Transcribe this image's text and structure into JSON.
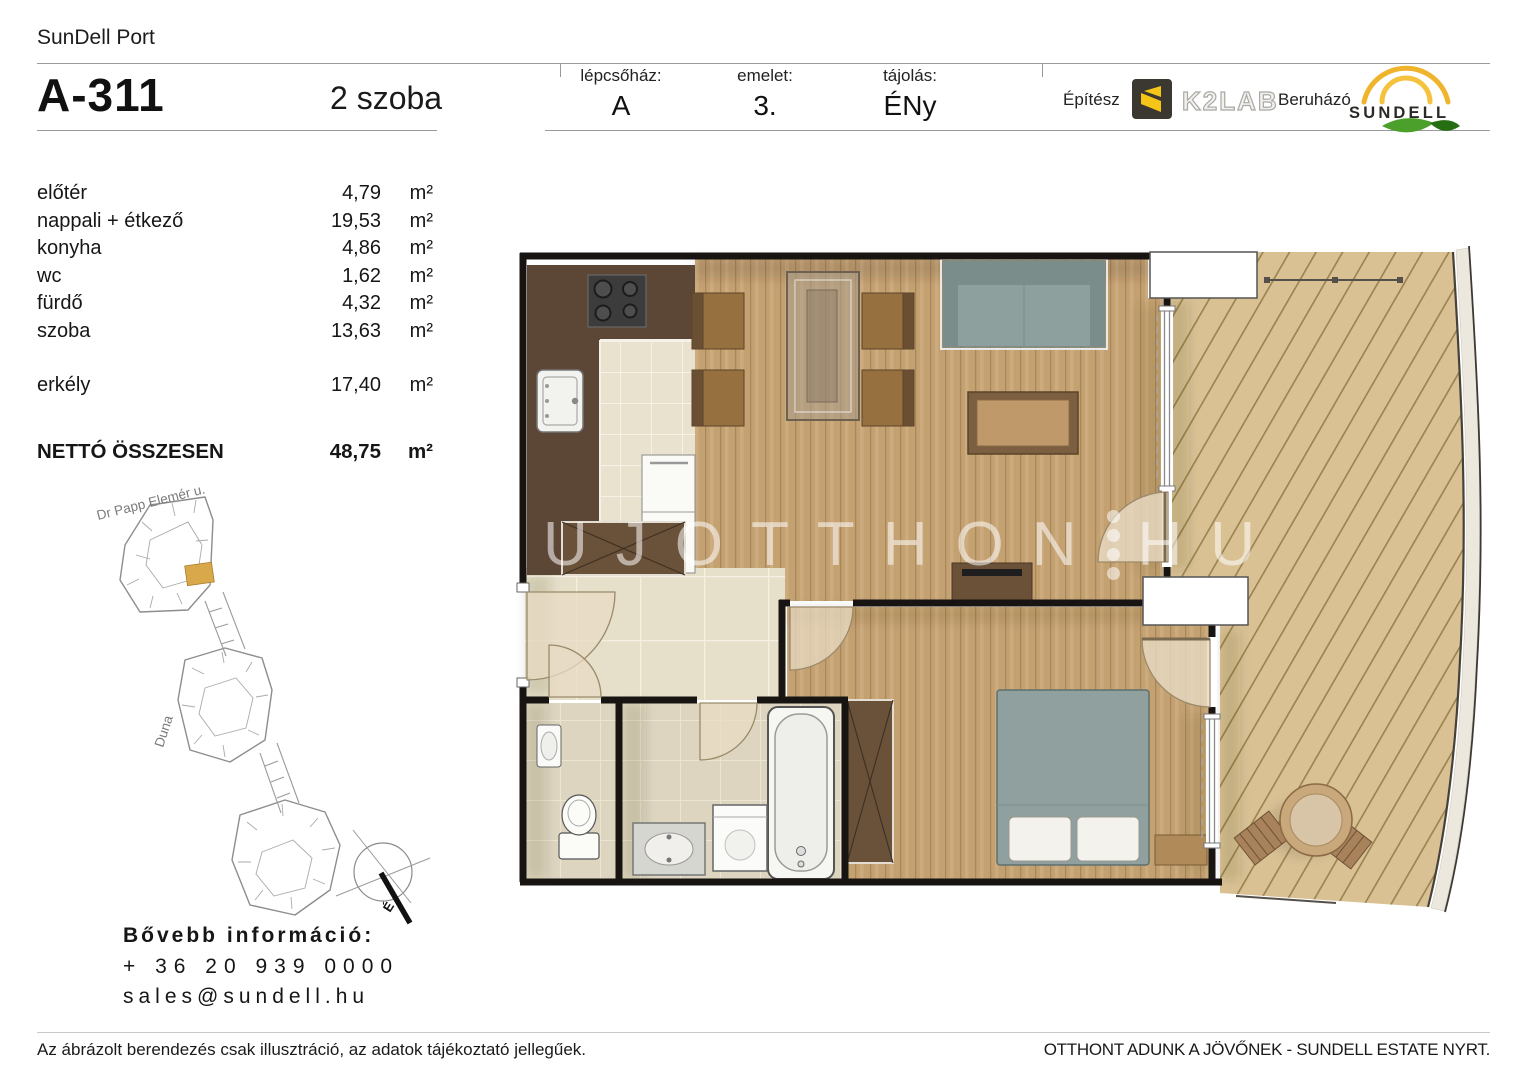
{
  "header": {
    "project": "SunDell Port",
    "unit": "A-311",
    "rooms": "2 szoba",
    "fields": [
      {
        "label": "lépcsőház:",
        "value": "A"
      },
      {
        "label": "emelet:",
        "value": "3."
      },
      {
        "label": "tájolás:",
        "value": "ÉNy"
      }
    ],
    "architect_label": "Építész",
    "architect_name": "K2LAB",
    "developer_label": "Beruházó",
    "developer_name": "SUNDELL"
  },
  "areas": {
    "rows": [
      {
        "name": "előtér",
        "value": "4,79",
        "unit": "m²"
      },
      {
        "name": "nappali + étkező",
        "value": "19,53",
        "unit": "m²"
      },
      {
        "name": "konyha",
        "value": "4,86",
        "unit": "m²"
      },
      {
        "name": "wc",
        "value": "1,62",
        "unit": "m²"
      },
      {
        "name": "fürdő",
        "value": "4,32",
        "unit": "m²"
      },
      {
        "name": "szoba",
        "value": "13,63",
        "unit": "m²"
      },
      {
        "name": "erkély",
        "value": "17,40",
        "unit": "m²"
      }
    ],
    "total": {
      "name": "NETTÓ ÖSSZESEN",
      "value": "48,75",
      "unit": "m²"
    }
  },
  "map": {
    "street": "Dr Papp Elemér u.",
    "river": "Duna",
    "compass": "É",
    "highlight_color": "#d9a84b"
  },
  "contact": {
    "heading": "Bővebb információ:",
    "phone": "+ 36 20 939 0000",
    "email": "sales@sundell.hu"
  },
  "footer": {
    "left": "Az ábrázolt berendezés csak illusztráció, az adatok tájékoztató jellegűek.",
    "right": "OTTHONT ADUNK A JÖVŐNEK - SUNDELL ESTATE NYRT."
  },
  "watermark": {
    "part1": "UJOTTHON",
    "part2": "HU"
  },
  "colors": {
    "accent_yellow": "#f0b42c",
    "logo_green": "#4aa02a",
    "wood_floor": "#c4a171",
    "deck": "#d9c194",
    "tile": "#e6dfca",
    "counter_brown": "#5c4636",
    "furniture_gray": "#8ea09d"
  }
}
